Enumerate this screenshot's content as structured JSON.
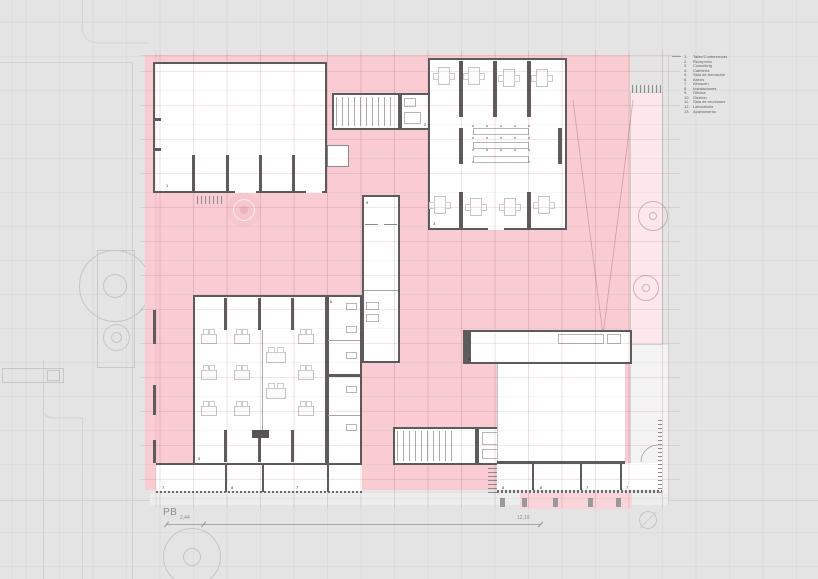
{
  "plan": {
    "title": "PB",
    "dim_small": "2,44",
    "dim_large": "12,19"
  },
  "legend": {
    "items": [
      {
        "num": "1.",
        "label": "Taller/Conferencias"
      },
      {
        "num": "2.",
        "label": "Recepción"
      },
      {
        "num": "3.",
        "label": "Coworking"
      },
      {
        "num": "4.",
        "label": "Cafetería"
      },
      {
        "num": "5.",
        "label": "Sala de formación"
      },
      {
        "num": "6.",
        "label": "Aseos"
      },
      {
        "num": "7.",
        "label": "Almacén"
      },
      {
        "num": "8.",
        "label": "Instalaciones"
      },
      {
        "num": "9.",
        "label": "Oficina"
      },
      {
        "num": "10.",
        "label": "Gestión"
      },
      {
        "num": "11.",
        "label": "Sala de reuniones"
      },
      {
        "num": "12.",
        "label": "Laboratorio"
      },
      {
        "num": "13.",
        "label": "Apartamento"
      }
    ]
  },
  "room_labels": {
    "taller": "1",
    "recepcion": "2",
    "coworking": "3",
    "cafeteria": "4",
    "formacion": "5",
    "aseos": "6",
    "oficina": "9",
    "bl1": "7",
    "bl2": "8",
    "bl3": "7",
    "br1": "8",
    "br2": "8",
    "br3": "7",
    "br4": "7"
  },
  "colors": {
    "context_gray": "#e4e4e4",
    "site_pink": "#f8ccd2",
    "light_pink": "#fce8eb",
    "wall_dark": "#5c5c5c",
    "room_white": "#ffffff"
  }
}
